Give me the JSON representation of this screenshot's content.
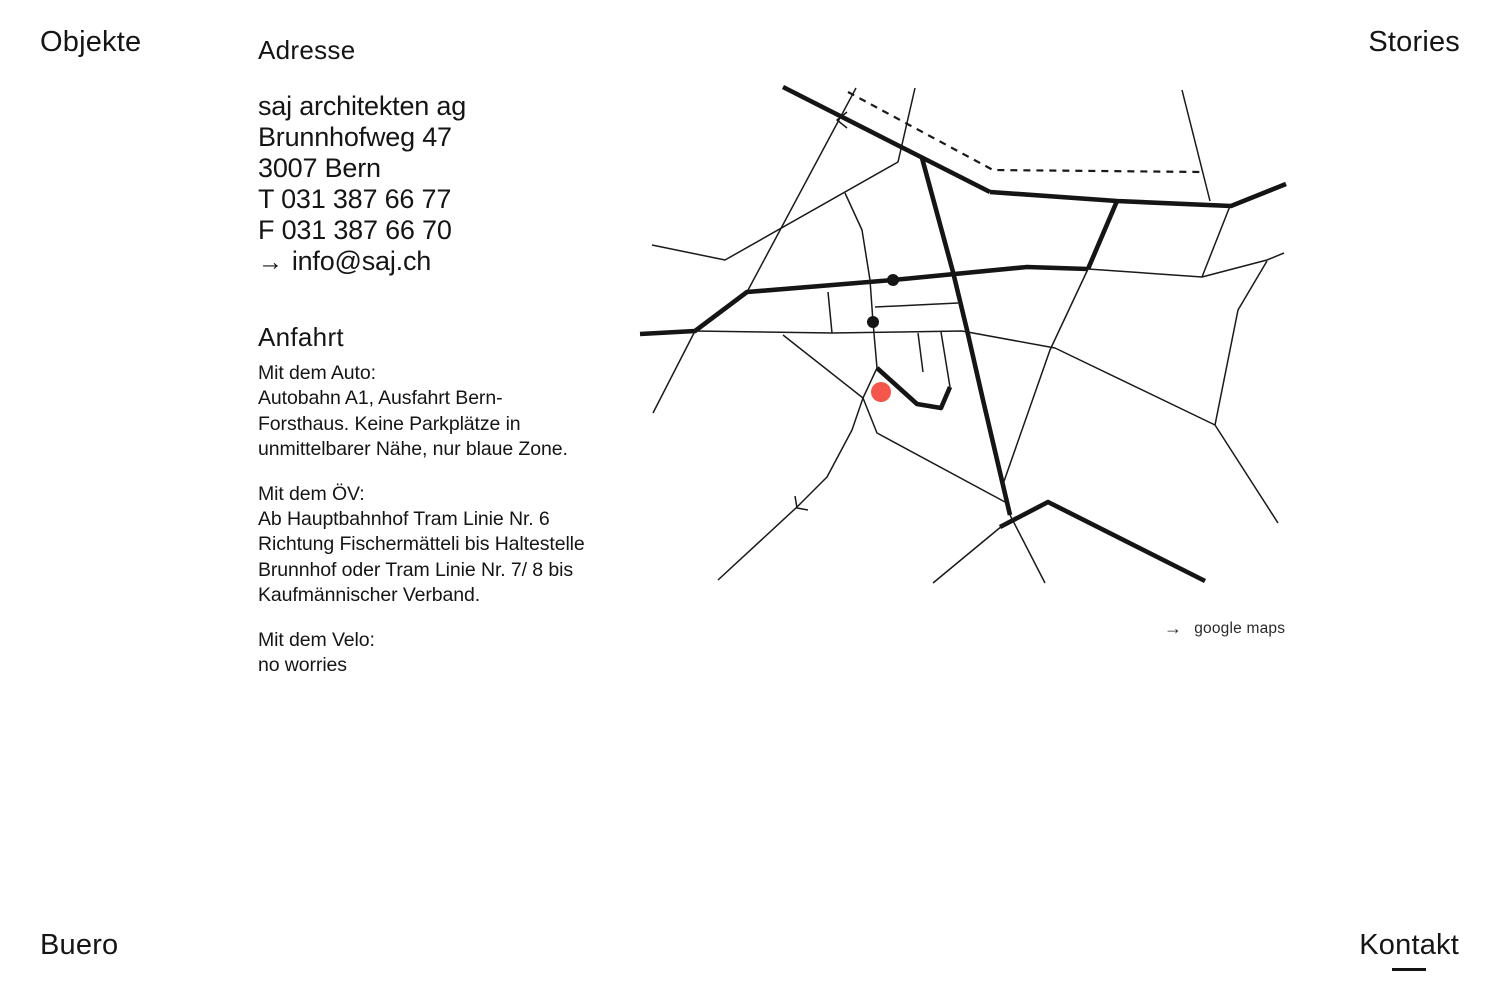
{
  "nav": {
    "objekte": "Objekte",
    "stories": "Stories",
    "buero": "Buero",
    "kontakt": "Kontakt"
  },
  "address": {
    "heading": "Adresse",
    "lines": [
      "saj architekten ag",
      "Brunnhofweg 47",
      "3007 Bern",
      "T 031 387 66 77",
      "F 031 387 66 70"
    ],
    "email": {
      "arrow": "→",
      "text": "info@saj.ch"
    }
  },
  "anfahrt": {
    "heading": "Anfahrt",
    "car": [
      "Mit dem Auto:",
      "Autobahn A1, Ausfahrt Bern-",
      "Forsthaus. Keine Parkplätze in",
      "unmittelbarer Nähe, nur blaue Zone."
    ],
    "transit": [
      "Mit dem ÖV:",
      "Ab Hauptbahnhof Tram Linie Nr. 6",
      "Richtung Fischermätteli bis Haltestelle",
      "Brunnhof oder Tram Linie Nr. 7/ 8 bis",
      "Kaufmännischer Verband."
    ],
    "bike": [
      "Mit dem Velo:",
      "no worries"
    ]
  },
  "map": {
    "link": {
      "arrow": "→",
      "label": "google maps"
    },
    "colors": {
      "road": "#151515",
      "marker_red": "#f4564b"
    },
    "lines": [
      {
        "type": "thick",
        "points": [
          [
            783,
            87
          ],
          [
            990,
            192
          ]
        ]
      },
      {
        "type": "thick",
        "points": [
          [
            990,
            192
          ],
          [
            1117,
            201
          ],
          [
            1231,
            206
          ],
          [
            1286,
            184
          ]
        ]
      },
      {
        "type": "thick",
        "points": [
          [
            922,
            158
          ],
          [
            953,
            272
          ],
          [
            967,
            330
          ],
          [
            983,
            400
          ],
          [
            1010,
            515
          ]
        ]
      },
      {
        "type": "thick",
        "points": [
          [
            640,
            334
          ],
          [
            695,
            331
          ],
          [
            747,
            292
          ],
          [
            893,
            280
          ],
          [
            1027,
            267
          ],
          [
            1088,
            269
          ]
        ]
      },
      {
        "type": "thick",
        "points": [
          [
            1117,
            201
          ],
          [
            1088,
            269
          ]
        ]
      },
      {
        "type": "thick",
        "points": [
          [
            877,
            368
          ],
          [
            917,
            404
          ],
          [
            941,
            408
          ],
          [
            950,
            387
          ]
        ]
      },
      {
        "type": "thick",
        "points": [
          [
            1000,
            527
          ],
          [
            1048,
            502
          ],
          [
            1205,
            581
          ]
        ]
      },
      {
        "type": "thin",
        "points": [
          [
            652,
            245
          ],
          [
            725,
            260
          ],
          [
            898,
            162
          ],
          [
            915,
            88
          ]
        ]
      },
      {
        "type": "thin",
        "points": [
          [
            845,
            193
          ],
          [
            862,
            230
          ],
          [
            870,
            280
          ],
          [
            873,
            322
          ],
          [
            877,
            368
          ]
        ]
      },
      {
        "type": "thin",
        "points": [
          [
            856,
            88
          ],
          [
            747,
            292
          ]
        ]
      },
      {
        "type": "thin",
        "points": [
          [
            1182,
            90
          ],
          [
            1210,
            201
          ]
        ]
      },
      {
        "type": "thin",
        "points": [
          [
            1230,
            206
          ],
          [
            1202,
            277
          ]
        ]
      },
      {
        "type": "thin",
        "points": [
          [
            695,
            331
          ],
          [
            832,
            333
          ],
          [
            900,
            332
          ],
          [
            962,
            331
          ],
          [
            1055,
            348
          ],
          [
            1215,
            425
          ],
          [
            1278,
            523
          ]
        ]
      },
      {
        "type": "thin",
        "points": [
          [
            1088,
            269
          ],
          [
            1202,
            277
          ],
          [
            1267,
            260
          ],
          [
            1284,
            253
          ]
        ]
      },
      {
        "type": "thin",
        "points": [
          [
            1267,
            261
          ],
          [
            1238,
            310
          ],
          [
            1215,
            425
          ]
        ]
      },
      {
        "type": "thin",
        "points": [
          [
            1088,
            269
          ],
          [
            1050,
            350
          ],
          [
            1002,
            487
          ]
        ]
      },
      {
        "type": "thin",
        "points": [
          [
            828,
            292
          ],
          [
            832,
            333
          ]
        ]
      },
      {
        "type": "thin",
        "points": [
          [
            875,
            307
          ],
          [
            958,
            303
          ]
        ]
      },
      {
        "type": "thin",
        "points": [
          [
            918,
            333
          ],
          [
            923,
            372
          ]
        ]
      },
      {
        "type": "thin",
        "points": [
          [
            941,
            332
          ],
          [
            950,
            387
          ]
        ]
      },
      {
        "type": "thin",
        "points": [
          [
            783,
            335
          ],
          [
            863,
            398
          ],
          [
            877,
            433
          ],
          [
            1005,
            502
          ]
        ]
      },
      {
        "type": "thin",
        "points": [
          [
            877,
            368
          ],
          [
            863,
            398
          ],
          [
            852,
            430
          ],
          [
            827,
            477
          ],
          [
            797,
            507
          ],
          [
            718,
            580
          ]
        ]
      },
      {
        "type": "thin",
        "points": [
          [
            695,
            331
          ],
          [
            653,
            413
          ]
        ]
      },
      {
        "type": "thin",
        "points": [
          [
            1008,
            521
          ],
          [
            933,
            583
          ]
        ]
      },
      {
        "type": "thin",
        "points": [
          [
            1010,
            515
          ],
          [
            1045,
            583
          ]
        ]
      },
      {
        "type": "thin",
        "points": [
          [
            847,
            112
          ],
          [
            837,
            120
          ],
          [
            847,
            128
          ]
        ]
      },
      {
        "type": "thin",
        "points": [
          [
            795,
            496
          ],
          [
            797,
            508
          ],
          [
            808,
            510
          ]
        ]
      },
      {
        "type": "dashed",
        "points": [
          [
            848,
            92
          ],
          [
            993,
            170
          ],
          [
            1203,
            172
          ]
        ]
      }
    ],
    "dots": [
      {
        "name": "tram-stop-dot-1",
        "x": 893,
        "y": 280,
        "r": 6,
        "color": "#151515"
      },
      {
        "name": "tram-stop-dot-2",
        "x": 873,
        "y": 322,
        "r": 6,
        "color": "#151515"
      },
      {
        "name": "office-location-marker",
        "x": 881,
        "y": 392,
        "r": 10,
        "color": "#f4564b"
      }
    ]
  }
}
